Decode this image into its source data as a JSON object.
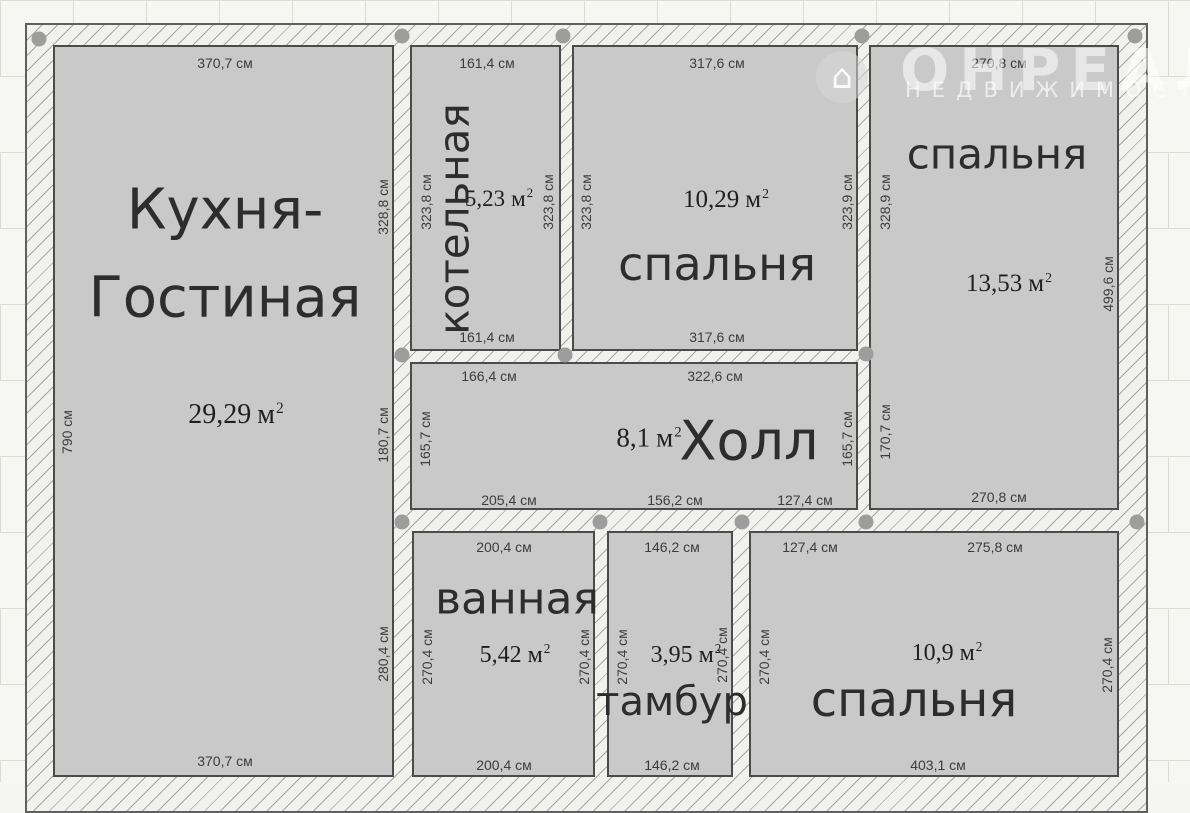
{
  "plan": {
    "unit": "см",
    "rooms": [
      {
        "key": "kitchen-living",
        "name_line1": "Кухня-",
        "name_line2": "Гостиная",
        "area_value": "29,29",
        "area_unit": "м",
        "area_exp": "2",
        "dim_top": "370,7 см",
        "dim_bottom": "370,7 см",
        "dim_left": "790 см",
        "dim_right_upper": "328,8 см",
        "dim_right_middle": "180,7 см",
        "dim_right_lower": "280,4 см"
      },
      {
        "key": "boiler-room",
        "name": "котельная",
        "area_value": "5,23",
        "area_unit": "м",
        "area_exp": "2",
        "dim_top": "161,4 см",
        "dim_bottom": "161,4 см",
        "dim_left": "323,8 см",
        "dim_right": "323,8 см"
      },
      {
        "key": "bedroom-top",
        "name": "спальня",
        "area_value": "10,29",
        "area_unit": "м",
        "area_exp": "2",
        "dim_top": "317,6 см",
        "dim_bottom": "317,6 см",
        "dim_left": "323,8 см",
        "dim_right": "323,9 см"
      },
      {
        "key": "bedroom-right",
        "name": "спальня",
        "area_value": "13,53",
        "area_unit": "м",
        "area_exp": "2",
        "dim_top": "270,8 см",
        "dim_bottom": "270,8 см",
        "dim_left_upper": "328,9 см",
        "dim_left_lower": "170,7 см",
        "dim_right": "499,6 см"
      },
      {
        "key": "hall",
        "name": "Холл",
        "area_value": "8,1",
        "area_unit": "м",
        "area_exp": "2",
        "dim_top_left": "166,4 см",
        "dim_top_right": "322,6 см",
        "dim_left": "165,7 см",
        "dim_right": "165,7 см",
        "dims_bottom": [
          "205,4 см",
          "156,2 см",
          "127,4 см"
        ]
      },
      {
        "key": "bathroom",
        "name": "ванная",
        "area_value": "5,42",
        "area_unit": "м",
        "area_exp": "2",
        "dim_top": "200,4 см",
        "dim_bottom": "200,4 см",
        "dim_left": "270,4 см",
        "dim_right": "270,4 см"
      },
      {
        "key": "vestibule",
        "name": "тамбур",
        "area_value": "3,95",
        "area_unit": "м",
        "area_exp": "2",
        "dim_top": "146,2 см",
        "dim_bottom": "146,2 см",
        "dim_left": "270,4 см",
        "dim_right": "270,4 см"
      },
      {
        "key": "bedroom-bottom",
        "name": "спальня",
        "area_value": "10,9",
        "area_unit": "м",
        "area_exp": "2",
        "dim_top_left": "127,4 см",
        "dim_top_right": "275,8 см",
        "dim_bottom": "403,1 см",
        "dim_left": "270,4 см",
        "dim_right": "270,4 см"
      }
    ]
  },
  "watermark": {
    "brand": "ОНРЕАЛ",
    "subtitle": "НЕДВИЖИМОСТЬ",
    "house_glyph": "⌂"
  },
  "colors": {
    "room_fill": "#c9c9c9",
    "room_border": "#4b4b4b",
    "wall_fill": "#f1f1ee",
    "wall_hatch_line": "#a6a6a4",
    "junction_dot": "#9d9d9d",
    "name_text": "#2d2d2d",
    "dim_text": "#3c3c3c"
  }
}
